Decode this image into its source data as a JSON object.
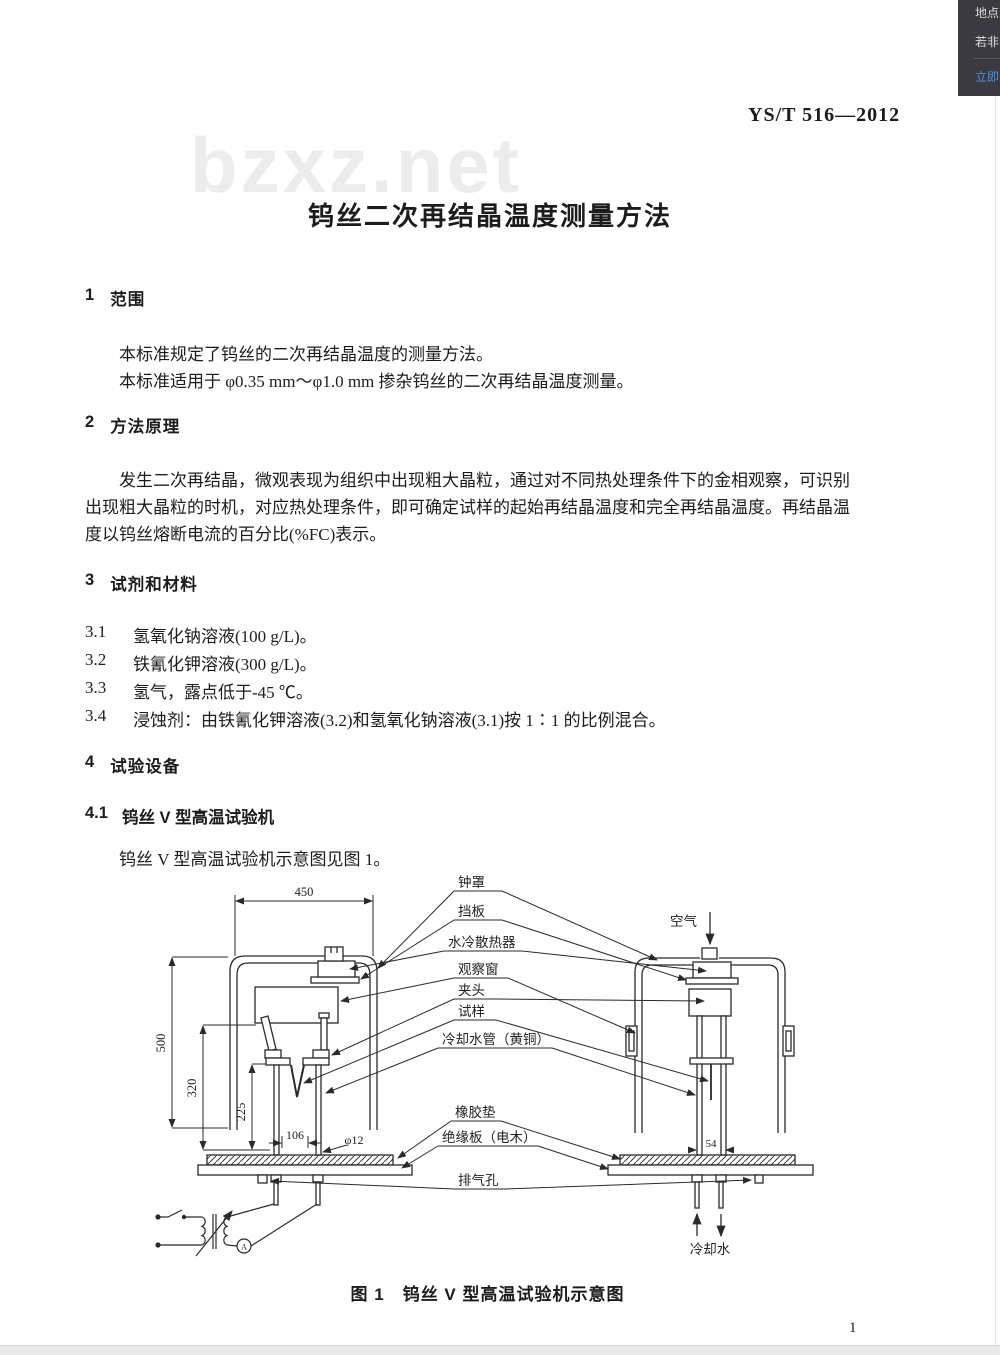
{
  "overlay": {
    "line1": "地点",
    "line2": "若非",
    "link": "立即"
  },
  "watermark": "bzxz.net",
  "header": {
    "doc_code": "YS/T 516—2012"
  },
  "title": "钨丝二次再结晶温度测量方法",
  "section1": {
    "num": "1",
    "title": "范围",
    "para1": "本标准规定了钨丝的二次再结晶温度的测量方法。",
    "para2": "本标准适用于 φ0.35 mm～φ1.0 mm 掺杂钨丝的二次再结晶温度测量。"
  },
  "section2": {
    "num": "2",
    "title": "方法原理",
    "line1": "发生二次再结晶，微观表现为组织中出现粗大晶粒，通过对不同热处理条件下的金相观察，可识别",
    "line2": "出现粗大晶粒的时机，对应热处理条件，即可确定试样的起始再结晶温度和完全再结晶温度。再结晶温",
    "line3": "度以钨丝熔断电流的百分比(%FC)表示。"
  },
  "section3": {
    "num": "3",
    "title": "试剂和材料",
    "items": [
      {
        "num": "3.1",
        "text": "氢氧化钠溶液(100 g/L)。"
      },
      {
        "num": "3.2",
        "text": "铁氰化钾溶液(300 g/L)。"
      },
      {
        "num": "3.3",
        "text": "氢气，露点低于-45 ℃。"
      },
      {
        "num": "3.4",
        "text": "浸蚀剂：由铁氰化钾溶液(3.2)和氢氧化钠溶液(3.1)按 1∶1 的比例混合。"
      }
    ]
  },
  "section4": {
    "num": "4",
    "title": "试验设备",
    "sub_num": "4.1",
    "sub_title": "钨丝 V 型高温试验机",
    "para": "钨丝 V 型高温试验机示意图见图 1。"
  },
  "figure": {
    "caption": "图 1　钨丝 V 型高温试验机示意图",
    "labels": {
      "bell_jar": "钟罩",
      "baffle": "挡板",
      "radiator": "水冷散热器",
      "window": "观察窗",
      "chuck": "夹头",
      "specimen": "试样",
      "cooling_pipe": "冷却水管（黄铜）",
      "rubber_pad": "橡胶垫",
      "insulation_board": "绝缘板（电木）",
      "vent_hole": "排气孔",
      "air": "空气",
      "cooling_water": "冷却水"
    },
    "dimensions": {
      "width450": "450",
      "height500": "500",
      "d320": "320",
      "d225": "225",
      "d106": "106",
      "rod": "φ12",
      "d54": "54"
    }
  },
  "footer": {
    "page_number": "1"
  }
}
